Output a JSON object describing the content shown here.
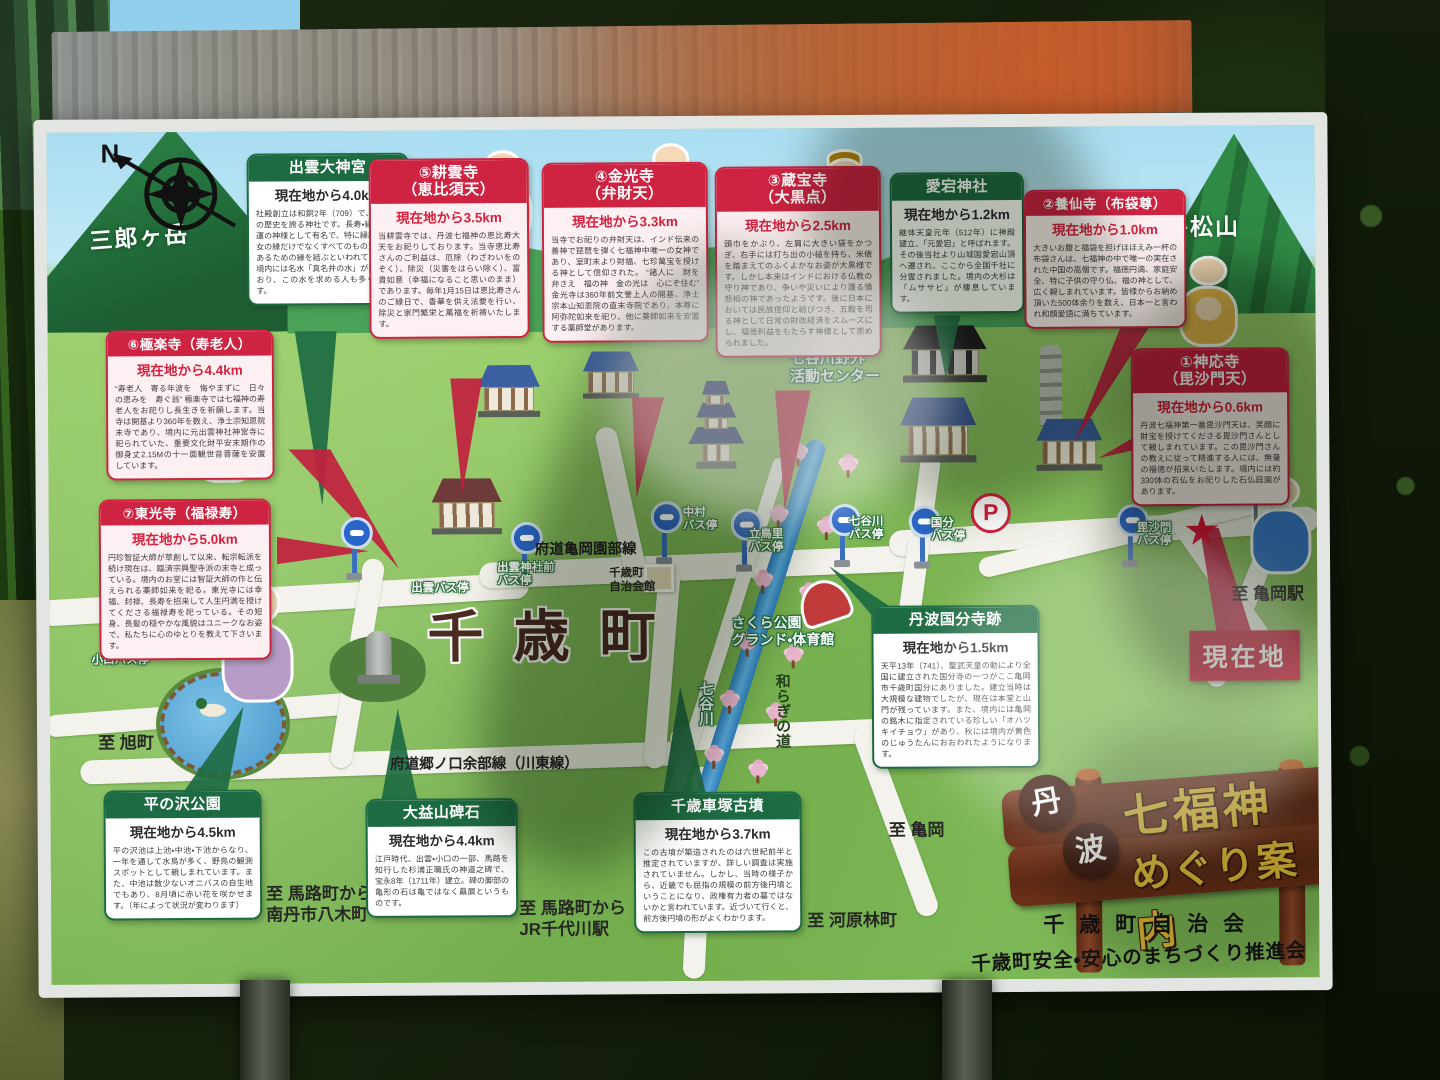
{
  "colors": {
    "green_box": "#1d6b42",
    "red_box": "#cf2342",
    "road": "#f3f2ec",
    "current_location_red": "#c3192e",
    "map_green": "#8cc45f",
    "gold_text": "#e8c23a"
  },
  "map": {
    "compass": "N",
    "mountains": [
      "三郎ヶ岳",
      "牛松山"
    ],
    "town": "千歳町",
    "road_names": [
      "府道亀岡園部線",
      "府道郷ノ口余部線（川東線）"
    ],
    "river": "七谷川",
    "riverside_path": "和らぎの道",
    "facilities": [
      "七谷川野外\n活動センター",
      "さくら公園\nグランド・体育館",
      "千歳町\n自治会館"
    ],
    "directions": [
      "至 旭町",
      "至 馬路町から\n南丹市八木町",
      "至 馬路町から\nJR千代川駅",
      "至 河原林町",
      "至 亀岡",
      "至 亀岡駅"
    ],
    "bus_stops": [
      "小口バス停",
      "出雲台バス停",
      "出雲バス停",
      "出雲神社前\nバス停",
      "中村\nバス停",
      "立鳥里\nバス停",
      "七谷川\nバス停",
      "国分\nバス停",
      "毘沙門\nバス停"
    ],
    "current_location": "現在地",
    "parking": "P"
  },
  "info_boxes": [
    {
      "id": "izumo-daijingu",
      "style": "green",
      "title": "出雲大神宮",
      "subtitle": "",
      "distance": "現在地から4.0km",
      "body": "社殿創立は和銅2年（709）で、1300年の歴史を誇る神社です。長寿・縁結び・金運の神様として有名で、特に縁結びは男女の縁だけでなくすべてのものが幸福であるための縁を結ぶといわれています。境内には名水「真名井の水」が湧き出ており、この水を求める人も多く訪れます。"
    },
    {
      "id": "kounji",
      "style": "red",
      "title": "⑤耕雲寺",
      "subtitle": "（恵比須天）",
      "distance": "現在地から3.5km",
      "body": "当耕雲寺では、丹波七福神の恵比寿大天をお祀りしております。当寺恵比寿さんのご利益は、厄除（わざわいをのぞく）、除災（災害をはらい除く）、富貴如意（幸福になること思いのまま）であります。毎年1月15日は恵比寿さんのご縁日で、香華を供え法要を行い、除災と家門繁栄と萬福を祈祷いたします。"
    },
    {
      "id": "konkoji",
      "style": "red",
      "title": "④金光寺",
      "subtitle": "（弁財天）",
      "distance": "現在地から3.3km",
      "body": "当寺でお祀りの弁財天は、インド伝来の善神で琵琶を弾く七福神中唯一の女神であり、室町末より財福、七珍萬宝を授ける神として信仰された。\n“諸人に　財を弁さえ　福の神　金の光は　心にぞ住む”\n金光寺は360年前文誉上人の開基、浄土宗本山知恩院の直末寺院であり、本尊に阿弥陀如来を祀り、他に薬師如来を安置する薬師堂があります。"
    },
    {
      "id": "zohoji",
      "style": "red",
      "title": "③蔵宝寺",
      "subtitle": "（大黒点）",
      "distance": "現在地から2.5km",
      "body": "頭巾をかぶり、左肩に大きい袋をかつぎ、右手には打ち出の小槌を持ち、米俵を踏まえてのふくよかなお姿が大黒様です。しかし本来はインドにおける仏教の守り神であり、争いや災いにより護る憤怒相の神であったようです。後に日本においては民族信仰と結びつき、五穀を司る神として日常の財政経済をスムーズにし、福徳利益をもたらす神様として崇められました。"
    },
    {
      "id": "atago-jinja",
      "style": "green",
      "title": "愛宕神社",
      "subtitle": "",
      "distance": "現在地から1.2km",
      "body": "継体天皇元年（512年）に神殿建立、「元愛宕」と呼ばれます。その後当社より山城国愛宕山頂へ遷され、ここから全国千社に分霊されました。境内の大杉は「ムササビ」が棲息しています。"
    },
    {
      "id": "yosenji",
      "style": "red",
      "title": "②養仙寺（布袋尊）",
      "subtitle": "",
      "distance": "現在地から1.0km",
      "body": "大きいお腹と福袋を担げほほえみ一杯の布袋さんは、七福神の中で唯一の実在された中国の高僧です。福徳円満、家庭安全、特に子供の守り仏、福の神として、広く親しまれています。皆様からお納め頂いた500体余りを数え、日本一と言われ和顔愛語に満ちています。"
    },
    {
      "id": "gokurakuji",
      "style": "red",
      "title": "⑥極楽寺（寿老人）",
      "subtitle": "",
      "distance": "現在地から4.4km",
      "body": "“寿老人　寄る年波を　悔やまずに　日々の恵みを　寿ぐ翁”\n極楽寺では七福神の寿老人をお祀りし長生きを祈願します。当寺は開基より360年を数え、浄土宗知恩院末寺であり、境内に元出雲神社神宮寺に祀られていた、重要文化財平安末期作の御身丈2.15Mの十一面観世音菩薩を安置しています。"
    },
    {
      "id": "tokoji",
      "style": "red",
      "title": "⑦東光寺（福禄寿）",
      "subtitle": "",
      "distance": "現在地から5.0km",
      "body": "円珍智証大師が草創して以来、転宗転派を続け現在は、臨済宗興聖寺派の末寺と成っている。境内のお堂には智証大師の作と伝えられる薬師如来を祀る。東光寺には幸福、封禄、長寿を招来して人生円満を授けてくださる福禄寿を祀っている。その短身、長髪の穏やかな風貌はユニークなお姿で、私たちに心のゆとりを教えて下さいます。"
    },
    {
      "id": "jinnoji",
      "style": "red",
      "title": "①神応寺",
      "subtitle": "（毘沙門天）",
      "distance": "現在地から0.6km",
      "body": "丹波七福神第一番毘沙門天は、笑顔に財宝を授けてくださる毘沙門さんとして親しまれています。この毘沙門さんの教えに従って精進する人には、無量の福徳が招来いたします。境内には約330体の石仏をお祀りした石仏庭園があります。"
    },
    {
      "id": "tanba-kokubunji-ato",
      "style": "green",
      "title": "丹波国分寺跡",
      "subtitle": "",
      "distance": "現在地から1.5km",
      "body": "天平13年（741）、聖武天皇の勅により全国に建立された国分寺の一つがここ亀岡市千歳町国分にありました。建立当時は大規模な建物でしたが、現在は本堂と山門が残っています。また、境内には亀岡の銘木に指定されている珍しい「オハツキイチョウ」があり、秋には境内が黄色のじゅうたんにおおわれたようになります。"
    },
    {
      "id": "hiranosawa-koen",
      "style": "green",
      "title": "平の沢公園",
      "subtitle": "",
      "distance": "現在地から4.5km",
      "body": "平の沢池は上池・中池・下池からなり、一年を通して水鳥が多く、野鳥の観測スポットとして親しまれています。また、中池は数少ないオニバスの自生地でもあり、8月頃に赤い花を咲かせます。（年によって状況が変わります）"
    },
    {
      "id": "daiekisan-hiseki",
      "style": "green",
      "title": "大益山碑石",
      "subtitle": "",
      "distance": "現在地から4.4km",
      "body": "江戸時代、出雲・小口の一部、馬路を知行した杉浦正職氏の神道之碑で、宝永8年（1711年）建立。碑の脚部の亀形の石は亀ではなく贔屓というものです。"
    },
    {
      "id": "chitose-kurumazuka-kofun",
      "style": "green",
      "title": "千歳車塚古墳",
      "subtitle": "",
      "distance": "現在地から3.7km",
      "body": "この古墳が築造されたのは六世紀前半と推定されていますが、詳しい調査は実施されていません。しかし、当時の様子から、近畿でも屈指の規模の前方後円墳ということになり、政権有力者の墓ではないかと言われています。近づいて行くと、前方後円墳の形がよくわかります。"
    }
  ],
  "sign_board": {
    "region_chars": [
      "丹",
      "波"
    ],
    "title_line1": "七福神",
    "title_line2": "めぐり案内",
    "org1": "千歳町自治会",
    "org2": "千歳町安全・安心のまちづくり推進会議"
  }
}
